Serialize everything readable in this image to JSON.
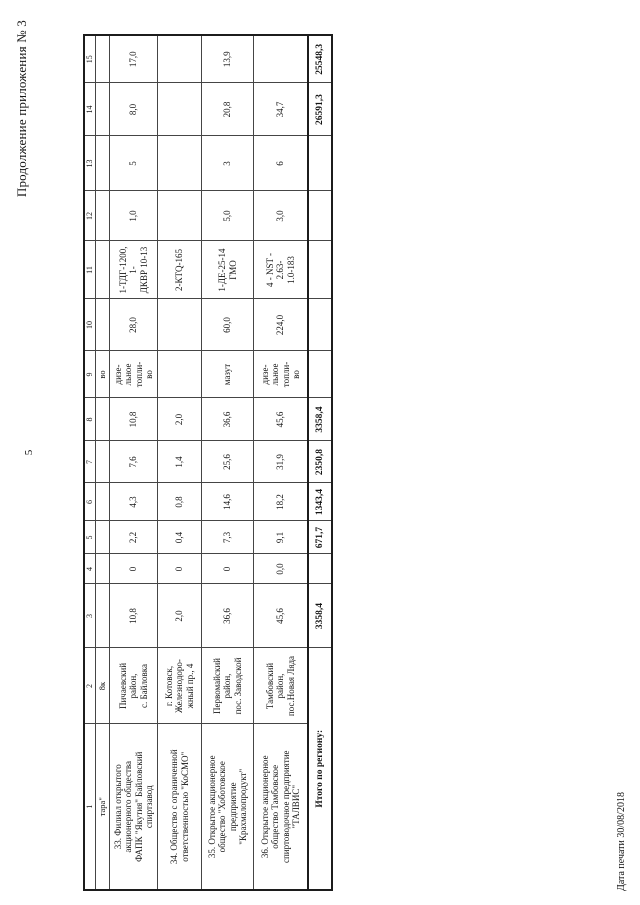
{
  "page": {
    "title": "Продолжение приложения № 3",
    "page_number": "5",
    "footer": "Дата печати 30/08/2018"
  },
  "table": {
    "column_numbers": [
      "1",
      "2",
      "3",
      "4",
      "5",
      "6",
      "7",
      "8",
      "9",
      "10",
      "11",
      "12",
      "13",
      "14",
      "15"
    ],
    "rows": [
      {
        "c1": "тара\"",
        "c2": "8к",
        "c3": "",
        "c4": "",
        "c5": "",
        "c6": "",
        "c7": "",
        "c8": "",
        "c9": "во",
        "c10": "",
        "c11": "",
        "c12": "",
        "c13": "",
        "c14": "",
        "c15": ""
      },
      {
        "c1": "33. Филиал  открытого\nакционерного общества\nФАПК \"Якутия\" Байловский\nспиртзавод",
        "c2": "Пичаевский\nрайон,\nс. Байловка",
        "c3": "10,8",
        "c4": "0",
        "c5": "2,2",
        "c6": "4,3",
        "c7": "7,6",
        "c8": "10,8",
        "c9": "дизе-\nльное\nтопли-\nво",
        "c10": "28,0",
        "c11": "1-ТДГ-1200, 1-\nДКВР 10-13",
        "c12": "1,0",
        "c13": "5",
        "c14": "8,0",
        "c15": "17,0"
      },
      {
        "c1": "34. Общество с ограниченной\nответственностью \"КоСМО\"",
        "c2": "г. Котовск,\nЖелезнодоро-\nжный пр., 4",
        "c3": "2,0",
        "c4": "0",
        "c5": "0,4",
        "c6": "0,8",
        "c7": "1,4",
        "c8": "2,0",
        "c9": "",
        "c10": "",
        "c11": "2-КТQ-165",
        "c12": "",
        "c13": "",
        "c14": "",
        "c15": ""
      },
      {
        "c1": "35. Открытое акционерное\nобщество \"Хоботовское\nпредприятие\n\"Крахмалопродукт\"",
        "c2": "Первомайский\nрайон,\nпос. Заводской",
        "c3": "36,6",
        "c4": "0",
        "c5": "7,3",
        "c6": "14,6",
        "c7": "25,6",
        "c8": "36,6",
        "c9": "мазут",
        "c10": "60,0",
        "c11": "1-ДЕ-25-14\nГМО",
        "c12": "5,0",
        "c13": "3",
        "c14": "20,8",
        "c15": "13,9"
      },
      {
        "c1": "36. Открытое акционерное\nобщество Тамбовское\nспиртоводочное предприятие\n\"ТАЛВИС\"",
        "c2": "Тамбовский\nрайон,\nпос.Новая Ляда",
        "c3": "45,6",
        "c4": "0,0",
        "c5": "9,1",
        "c6": "18,2",
        "c7": "31,9",
        "c8": "45,6",
        "c9": "дизе-\nльное\nтопли-\nво",
        "c10": "224,0",
        "c11": "4 - NST - 2.63-\n1.0-183",
        "c12": "3,0",
        "c13": "6",
        "c14": "34,7",
        "c15": ""
      }
    ],
    "total": {
      "label": "Итого по региону:",
      "c3": "3358,4",
      "c4": "",
      "c5": "671,7",
      "c6": "1343,4",
      "c7": "2350,8",
      "c8": "3358,4",
      "c9": "",
      "c10": "",
      "c11": "",
      "c12": "",
      "c13": "",
      "c14": "26591,3",
      "c15": "25548,3"
    }
  }
}
